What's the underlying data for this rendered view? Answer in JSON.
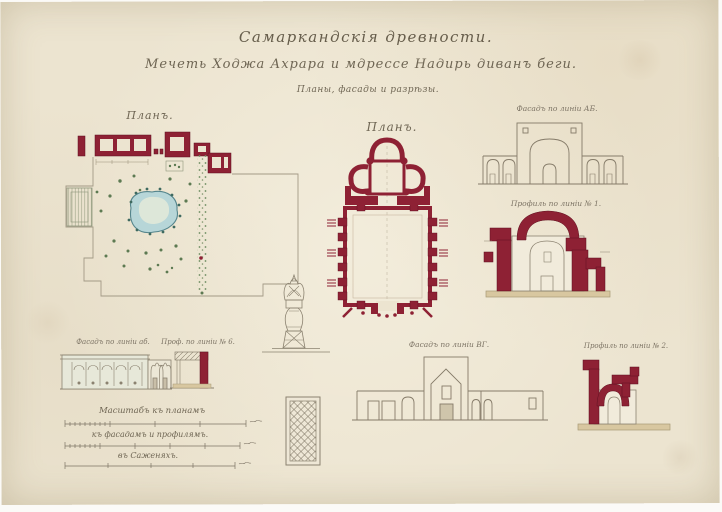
{
  "plate": {
    "title": "Самаркандскія древности.",
    "subtitle": "Мечеть Ходжа Ахрара и мдрессе Надирь диванъ беги.",
    "subtitle2": "Планы, фасады и разрѣзы.",
    "labels": {
      "garden_plan": "Планъ.",
      "mosque_plan": "Планъ.",
      "facade_ab_main": "Фасадъ по линіи АБ.",
      "profile_1": "Профиль по линіи № 1.",
      "facade_vg": "Фасадъ по линіи ВГ.",
      "profile_2": "Профиль по линіи № 2.",
      "facade_ab_small": "Фасадъ по линіи аб.",
      "profile_6": "Проф. по линіи № 6."
    },
    "scales": {
      "heading": "Масштабъ къ планамъ",
      "ruler2_label": "къ фасадамъ и профилямъ.",
      "ruler3_label": "въ Саженяхъ."
    },
    "colors": {
      "paper": "#ece4d0",
      "ink": "#7d7465",
      "crimson": "#8e2134",
      "crimson_dark": "#5f1120",
      "pond_fill": "#b7d6d8",
      "pond_edge": "#55858c",
      "foliage": "#5d7a52",
      "ground_wash": "#d8c7a0"
    }
  }
}
